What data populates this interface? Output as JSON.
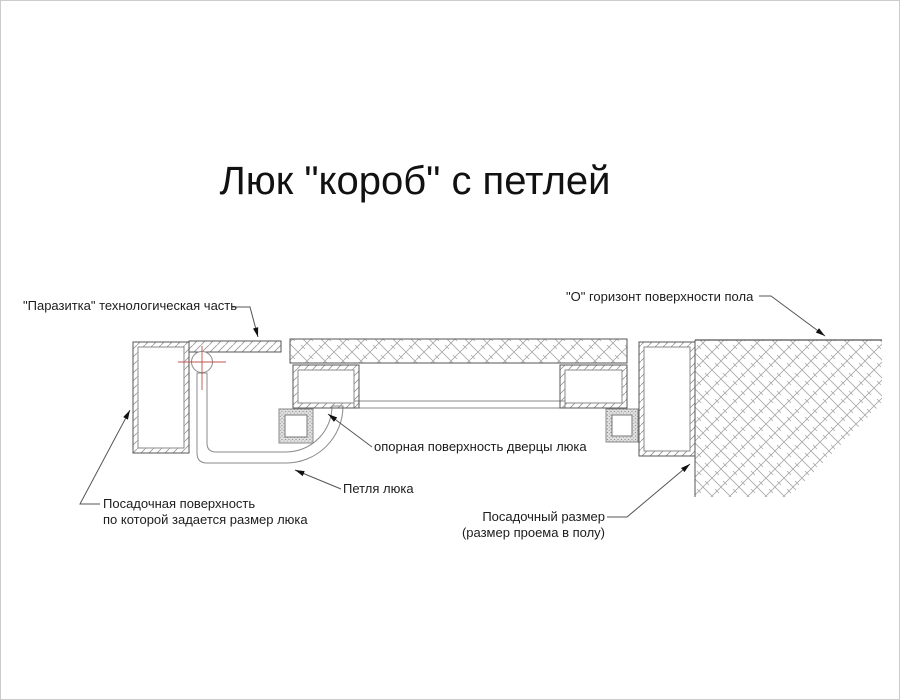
{
  "title": "Люк \"короб\" с петлей",
  "labels": {
    "parasitka": "\"Паразитка\" технологическая часть",
    "floor_horizon": "\"О\" горизонт поверхности пола",
    "support_surface": "опорная поверхность дверцы люка",
    "hinge": "Петля люка",
    "seating_surface_line1": "Посадочная поверхность",
    "seating_surface_line2": "по которой задается размер люка",
    "seating_size_line1": "Посадочный размер",
    "seating_size_line2": "(размер проема в полу)"
  },
  "drawing_parts": {
    "left_frame": "left-frame-profile",
    "right_frame": "right-frame-profile",
    "parasitka_strip": "technological-strip",
    "lid_slab": "hatch-door-tile-slab",
    "left_box": "door-left-box-profile",
    "right_box": "door-right-box-profile",
    "bottom_sheet": "door-bottom-sheet",
    "left_pad": "left-support-pad",
    "right_pad": "right-support-pad",
    "hinge_strap": "hinge-strap",
    "hinge_pivot": "hinge-pivot-center-mark",
    "floor": "concrete-floor-hatch"
  },
  "colors": {
    "background": "#ffffff",
    "outline": "#555555",
    "thin_line": "#8a8a8a",
    "hatch": "#9a9a9a",
    "centerline_red": "#c0504d",
    "text": "#1c1c1c",
    "arrow": "#111111"
  }
}
